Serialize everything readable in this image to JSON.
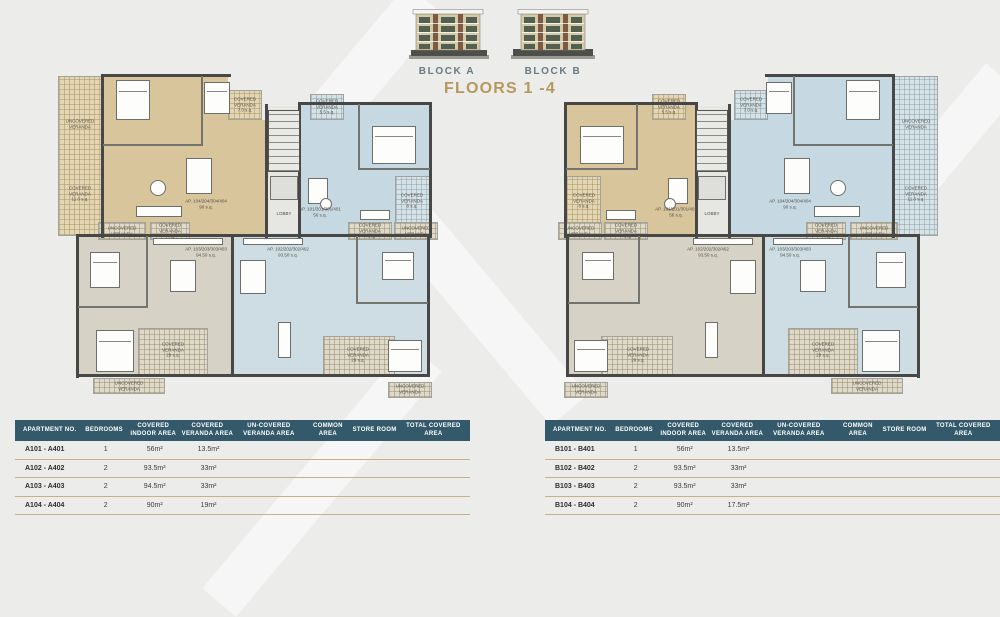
{
  "header": {
    "block_a_label": "BLOCK A",
    "block_b_label": "BLOCK B",
    "title": "FLOORS 1 -4"
  },
  "plan_labels": {
    "uncovered": "UNCOVERED\nVERANDA",
    "covered_11": "COVERED\nVERANDA\n11.0 s.q.",
    "covered_7": "COVERED\nVERANDA\n7.0 s.q.",
    "covered_55": "COVERED\nVERANDA\n5.5 s.q.",
    "covered_8": "COVERED\nVERANDA\n8 s.q.",
    "covered_4": "COVERED\nVERANDA\n4 s.q.",
    "covered_29": "COVERED\nVERANDA\n29 s.q.",
    "lobby": "LOBBY",
    "ap101": "AP. 101/201/301/401\n56 s.q.",
    "ap102": "AP. 102/202/302/402\n93.50 s.q.",
    "ap103": "AP. 103/203/303/403\n94.50 s.q.",
    "ap104": "AP. 104/204/304/404\n90 s.q."
  },
  "tables": {
    "headers": [
      "APARTMENT NO.",
      "BEDROOMS",
      "COVERED INDOOR AREA",
      "COVERED VERANDA AREA",
      "UN-COVERED VERANDA AREA",
      "COMMON AREA",
      "STORE ROOM",
      "TOTAL COVERED AREA"
    ],
    "block_a": {
      "rows": [
        [
          "A101 - A401",
          "1",
          "56m²",
          "13.5m²",
          "",
          "",
          "",
          ""
        ],
        [
          "A102 - A402",
          "2",
          "93.5m²",
          "33m²",
          "",
          "",
          "",
          ""
        ],
        [
          "A103 - A403",
          "2",
          "94.5m²",
          "33m²",
          "",
          "",
          "",
          ""
        ],
        [
          "A104 - A404",
          "2",
          "90m²",
          "19m²",
          "",
          "",
          "",
          ""
        ]
      ]
    },
    "block_b": {
      "rows": [
        [
          "B101 - B401",
          "1",
          "56m²",
          "13.5m²",
          "",
          "",
          "",
          ""
        ],
        [
          "B102 - B402",
          "2",
          "93.5m²",
          "33m²",
          "",
          "",
          "",
          ""
        ],
        [
          "B103 - B403",
          "2",
          "93.5m²",
          "33m²",
          "",
          "",
          "",
          ""
        ],
        [
          "B104 - B404",
          "2",
          "90m²",
          "17.5m²",
          "",
          "",
          "",
          ""
        ]
      ]
    }
  },
  "colors": {
    "accent_gold": "#b5985c",
    "table_header_bg": "#33596a",
    "block_label": "#687a84",
    "unit_tan": "#d8c59b",
    "unit_blue": "#c6d9e2",
    "unit_gray": "#d6d3c6",
    "wall": "#474745"
  }
}
